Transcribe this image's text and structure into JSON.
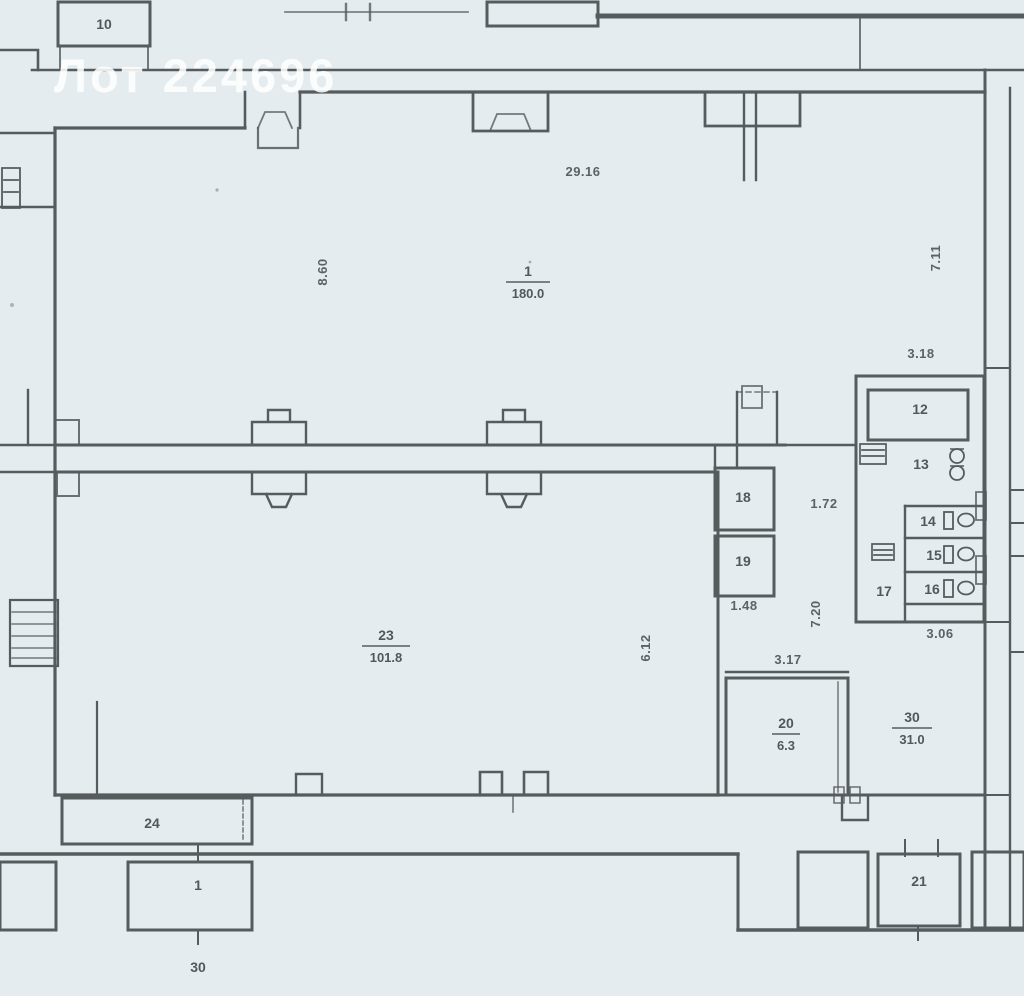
{
  "document": {
    "type": "scanned floor plan",
    "watermark": "Лот 224696"
  },
  "colors": {
    "paper": "#e9eef1",
    "wall": "#565b5e",
    "ink": "#3e4347",
    "watermark": "#ffffff"
  },
  "rooms": {
    "r10": {
      "number": "10"
    },
    "r1_main": {
      "number": "1",
      "area": "180.0"
    },
    "r23": {
      "number": "23",
      "area": "101.8"
    },
    "r18": {
      "number": "18"
    },
    "r19": {
      "number": "19"
    },
    "r12": {
      "number": "12"
    },
    "r13": {
      "number": "13"
    },
    "r14": {
      "number": "14"
    },
    "r15": {
      "number": "15"
    },
    "r16": {
      "number": "16"
    },
    "r17": {
      "number": "17"
    },
    "r20": {
      "number": "20",
      "area": "6.3"
    },
    "r30": {
      "number": "30",
      "area": "31.0"
    },
    "r24": {
      "number": "24"
    },
    "r1_porch": {
      "number": "1"
    },
    "r21": {
      "number": "21"
    },
    "r30_entry": {
      "number": "30"
    }
  },
  "dimensions": {
    "d29_16": "29.16",
    "d8_60": "8.60",
    "d7_11": "7.11",
    "d3_18": "3.18",
    "d1_72": "1.72",
    "d7_20": "7.20",
    "d1_48": "1.48",
    "d3_17": "3.17",
    "d3_06": "3.06",
    "d6_12": "6.12"
  }
}
